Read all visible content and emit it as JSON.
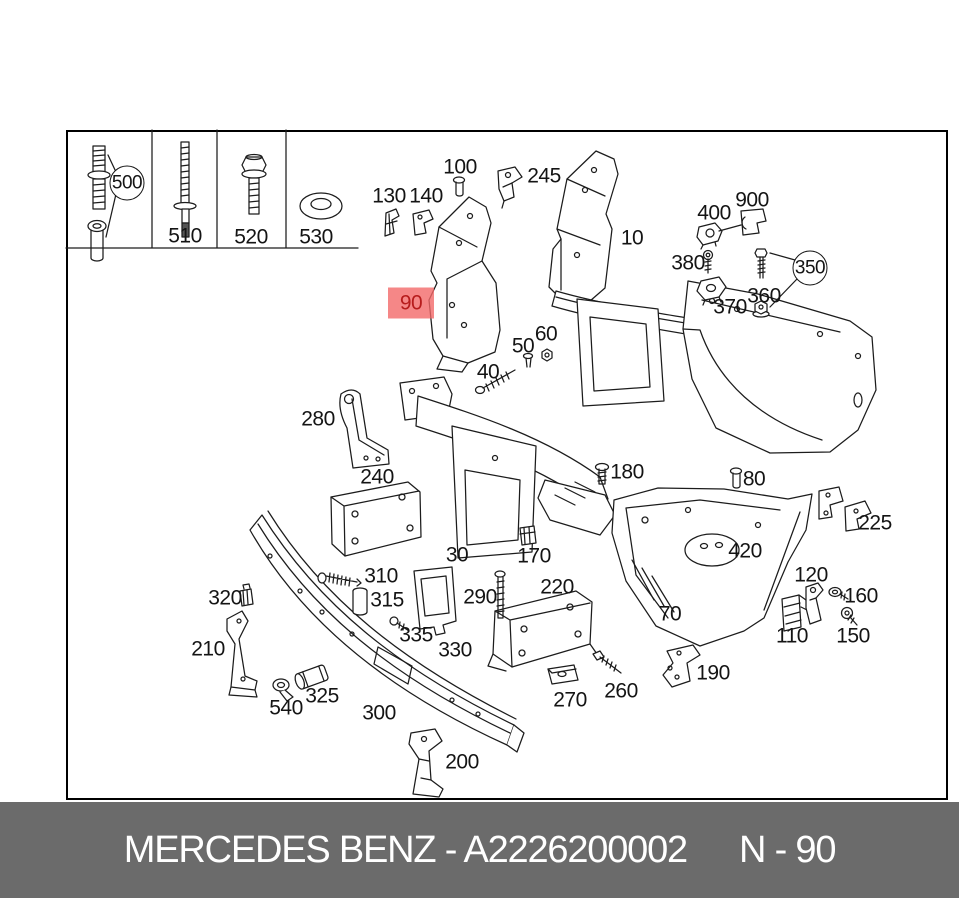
{
  "page": {
    "background": "#ffffff"
  },
  "diagram": {
    "frame_color": "#000000",
    "line_color": "#1c1c1c",
    "highlight": {
      "box_color": "rgba(242,105,105,0.8)",
      "text_color": "#b71c1c"
    },
    "legend_items": [
      "500",
      "510",
      "520",
      "530"
    ],
    "callouts": [
      {
        "label": "500",
        "x": 127,
        "y": 183,
        "circled": true
      },
      {
        "label": "510",
        "x": 185,
        "y": 236
      },
      {
        "label": "520",
        "x": 251,
        "y": 237
      },
      {
        "label": "530",
        "x": 316,
        "y": 237
      },
      {
        "label": "100",
        "x": 460,
        "y": 167
      },
      {
        "label": "245",
        "x": 544,
        "y": 176
      },
      {
        "label": "130",
        "x": 389,
        "y": 196
      },
      {
        "label": "140",
        "x": 426,
        "y": 196
      },
      {
        "label": "10",
        "x": 632,
        "y": 238
      },
      {
        "label": "400",
        "x": 714,
        "y": 213
      },
      {
        "label": "900",
        "x": 752,
        "y": 200
      },
      {
        "label": "380",
        "x": 688,
        "y": 263
      },
      {
        "label": "350",
        "x": 810,
        "y": 268,
        "circled": true
      },
      {
        "label": "360",
        "x": 764,
        "y": 296
      },
      {
        "label": "370",
        "x": 730,
        "y": 307
      },
      {
        "label": "90",
        "x": 411,
        "y": 303,
        "highlighted": true
      },
      {
        "label": "60",
        "x": 546,
        "y": 334
      },
      {
        "label": "50",
        "x": 523,
        "y": 346
      },
      {
        "label": "40",
        "x": 488,
        "y": 372
      },
      {
        "label": "280",
        "x": 318,
        "y": 419
      },
      {
        "label": "240",
        "x": 377,
        "y": 477
      },
      {
        "label": "180",
        "x": 627,
        "y": 472
      },
      {
        "label": "80",
        "x": 754,
        "y": 479
      },
      {
        "label": "225",
        "x": 875,
        "y": 523
      },
      {
        "label": "30",
        "x": 457,
        "y": 555
      },
      {
        "label": "170",
        "x": 534,
        "y": 556
      },
      {
        "label": "420",
        "x": 745,
        "y": 551
      },
      {
        "label": "120",
        "x": 811,
        "y": 575
      },
      {
        "label": "310",
        "x": 381,
        "y": 576
      },
      {
        "label": "315",
        "x": 387,
        "y": 600
      },
      {
        "label": "290",
        "x": 480,
        "y": 597
      },
      {
        "label": "220",
        "x": 557,
        "y": 587
      },
      {
        "label": "320",
        "x": 225,
        "y": 598
      },
      {
        "label": "335",
        "x": 416,
        "y": 635
      },
      {
        "label": "330",
        "x": 455,
        "y": 650
      },
      {
        "label": "70",
        "x": 670,
        "y": 614
      },
      {
        "label": "160",
        "x": 861,
        "y": 596
      },
      {
        "label": "110",
        "x": 792,
        "y": 636
      },
      {
        "label": "150",
        "x": 853,
        "y": 636
      },
      {
        "label": "210",
        "x": 208,
        "y": 649
      },
      {
        "label": "540",
        "x": 286,
        "y": 708
      },
      {
        "label": "325",
        "x": 322,
        "y": 696
      },
      {
        "label": "300",
        "x": 379,
        "y": 713
      },
      {
        "label": "270",
        "x": 570,
        "y": 700
      },
      {
        "label": "260",
        "x": 621,
        "y": 691
      },
      {
        "label": "190",
        "x": 713,
        "y": 673
      },
      {
        "label": "200",
        "x": 462,
        "y": 762
      }
    ]
  },
  "footer": {
    "brand_part": "MERCEDES BENZ - A2226200002",
    "diagram_ref": "N - 90",
    "background": "#6b6b6b",
    "text_color": "#ffffff"
  }
}
